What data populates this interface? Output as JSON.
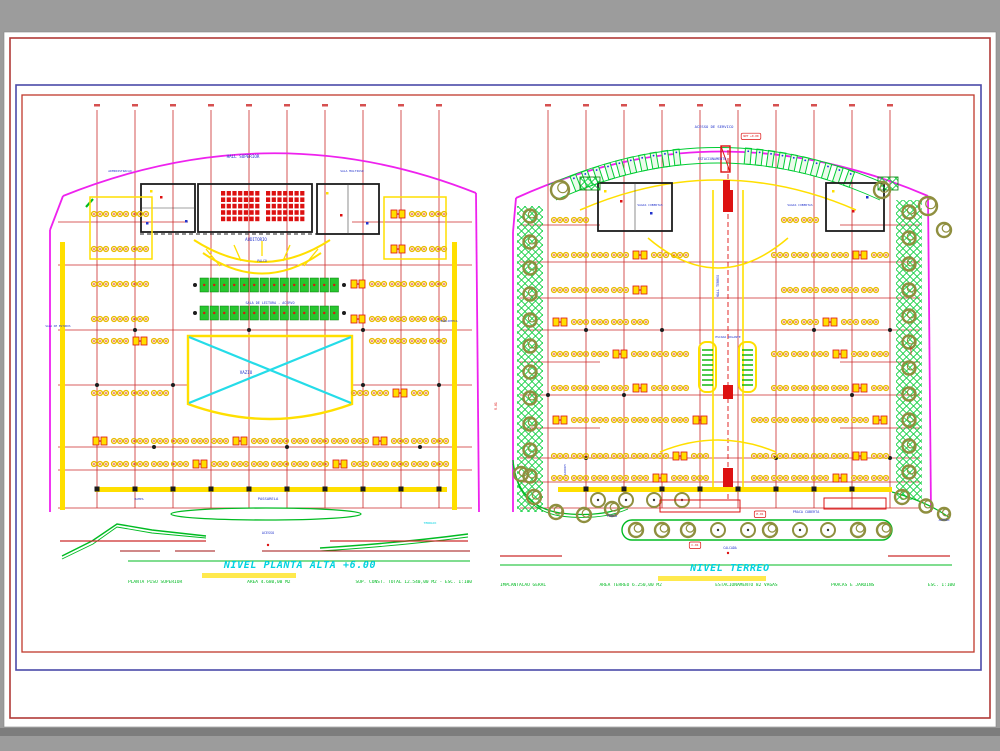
{
  "page": {
    "background": "#9c9c9c",
    "background_dark_band": "#7d7d7d",
    "sheet": "#ffffff",
    "frame_outer_color": "#b03a37",
    "frame_mid_color": "#4a4aa8",
    "frame_inner_color": "#c0392b"
  },
  "palette": {
    "grid_red": "#cc2a2a",
    "dark_red": "#a21212",
    "magenta": "#ee22ee",
    "yellow": "#ffdf00",
    "furniture_yellow": "#e8b900",
    "green": "#00bb22",
    "stall_green": "#00cc33",
    "olive": "#8f8f3f",
    "cyan": "#25dce8",
    "label_blue": "#2233cc",
    "seat_red": "#dd1111",
    "black": "#1c1c1c",
    "title_cyan": "#00d2e0",
    "highlight_yellow": "#ffe94d"
  },
  "plans": [
    {
      "id": "planta-alta",
      "title": "NIVEL PLANTA ALTA +6.00",
      "notes": [
        "PLANTA PISO SUPERIOR",
        "AREA 4.680,00 M2",
        "SUP. CONST. TOTAL 12.540,00 M2 - ESC. 1:100"
      ],
      "labels": [
        {
          "t": "HALL SUPERIOR",
          "x": 243,
          "y": 158,
          "s": 4.2
        },
        {
          "t": "ADMINISTRACAO",
          "x": 120,
          "y": 172,
          "s": 3
        },
        {
          "t": "SALA MULTIUSO",
          "x": 352,
          "y": 172,
          "s": 3
        },
        {
          "t": "AUDITORIO",
          "x": 256,
          "y": 241,
          "s": 4
        },
        {
          "t": "PALCO",
          "x": 262,
          "y": 262,
          "s": 3.2
        },
        {
          "t": "SALA DE LEITURA - ACERVO",
          "x": 270,
          "y": 304,
          "s": 3.4
        },
        {
          "t": "VAZIO",
          "x": 246,
          "y": 374,
          "s": 4.2
        },
        {
          "t": "SALA DE ESTUDOS",
          "x": 58,
          "y": 327,
          "s": 2.8
        },
        {
          "t": "BIBLIOTECA",
          "x": 449,
          "y": 322,
          "s": 2.8
        },
        {
          "t": "RAMPA",
          "x": 139,
          "y": 500,
          "s": 3
        },
        {
          "t": "PASSARELA",
          "x": 268,
          "y": 500,
          "s": 3.8
        },
        {
          "t": "ACESSO",
          "x": 268,
          "y": 534,
          "s": 3.4
        },
        {
          "t": "TERRACO",
          "x": 430,
          "y": 524,
          "s": 3,
          "c": "cyan"
        }
      ]
    },
    {
      "id": "terreo",
      "title": "NIVEL TERREO",
      "notes": [
        "IMPLANTACAO GERAL",
        "AREA TERREO 6.250,00 M2",
        "ESTACIONAMENTO 82 VAGAS",
        "PRACAS E JARDINS",
        "ESC. 1:100"
      ],
      "labels": [
        {
          "t": "ACESSO DE SERVICO",
          "x": 714,
          "y": 128,
          "s": 3.8
        },
        {
          "t": "NPT +0.00",
          "x": 751,
          "y": 137,
          "s": 2.8,
          "c": "red",
          "box": true
        },
        {
          "t": "ESTACIONAMENTO",
          "x": 712,
          "y": 160,
          "s": 3.4
        },
        {
          "t": "VAGAS COBERTAS",
          "x": 650,
          "y": 206,
          "s": 3
        },
        {
          "t": "VAGAS COBERTAS",
          "x": 800,
          "y": 206,
          "s": 3
        },
        {
          "t": "HALL TERREO",
          "x": 719,
          "y": 286,
          "s": 3.4,
          "r": -90
        },
        {
          "t": "ESCADA ROLANTE",
          "x": 728,
          "y": 338,
          "s": 3
        },
        {
          "t": "JARDIM",
          "x": 566,
          "y": 470,
          "s": 3,
          "r": -90
        },
        {
          "t": "RAMPA",
          "x": 912,
          "y": 350,
          "s": 3,
          "c": "red",
          "r": -90
        },
        {
          "t": "R-01",
          "x": 497,
          "y": 406,
          "s": 3.2,
          "c": "red",
          "r": -90
        },
        {
          "t": "PRACA",
          "x": 612,
          "y": 517,
          "s": 3.4
        },
        {
          "t": "PRACA COBERTA",
          "x": 806,
          "y": 513,
          "s": 3.4
        },
        {
          "t": "E-01",
          "x": 760,
          "y": 515,
          "s": 3,
          "c": "red",
          "box": true
        },
        {
          "t": "C-01",
          "x": 695,
          "y": 546,
          "s": 3,
          "c": "red",
          "box": true
        },
        {
          "t": "CALCADA",
          "x": 730,
          "y": 549,
          "s": 3.2
        },
        {
          "t": "ACESSO",
          "x": 944,
          "y": 521,
          "s": 3
        }
      ]
    }
  ]
}
